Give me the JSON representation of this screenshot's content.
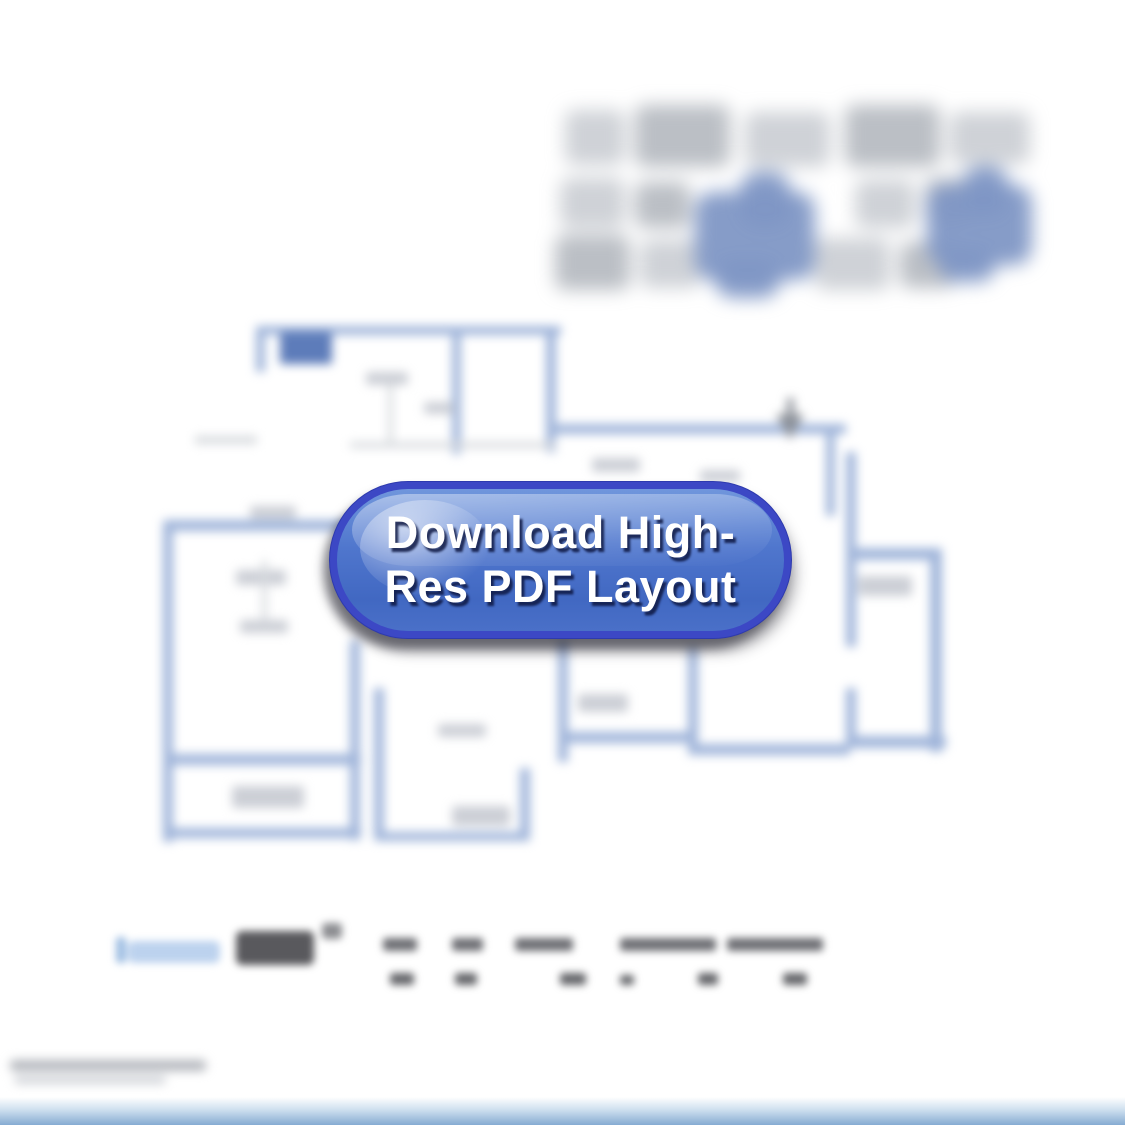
{
  "download_button": {
    "label": "Download High-Res PDF Layout",
    "line1": "Download High-",
    "line2": "Res PDF Layout",
    "colors": {
      "ring": "#3c48c5",
      "fill_top": "#7096dc",
      "fill_mid": "#4f76cd",
      "fill_bottom": "#4168c2",
      "text": "#ffffff"
    }
  },
  "palette": {
    "floorplan_wall_blue": "#a0b5da",
    "floorplan_wall_dark_blue": "#5d7cba",
    "logo_accent_blue": "#8097c5",
    "spec_label_light_blue": "#bcd2ee",
    "bottom_bar_blue": "#86abd2",
    "page_background": "#ffffff"
  }
}
